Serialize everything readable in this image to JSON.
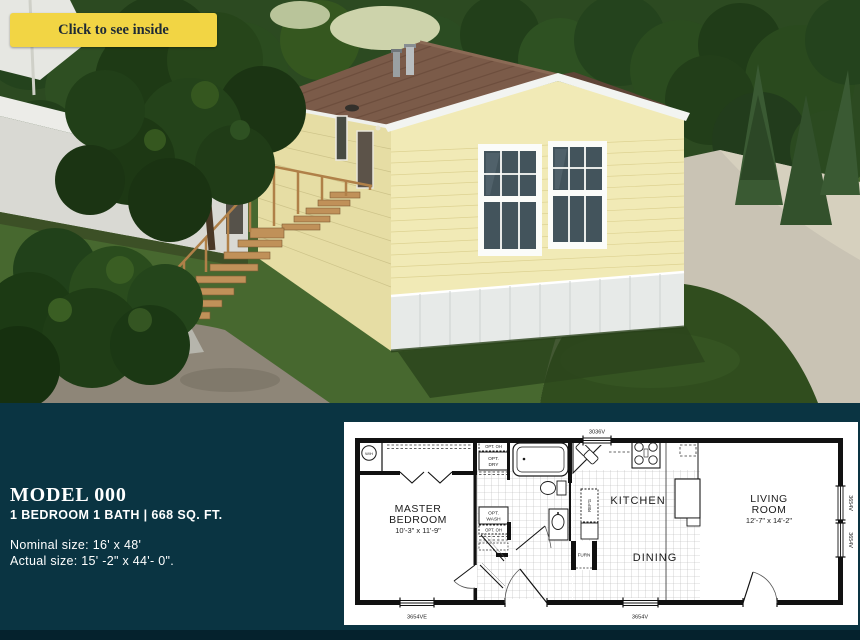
{
  "cta": {
    "label": "Click to see inside"
  },
  "info": {
    "title": "MODEL 000",
    "subtitle": "1 BEDROOM 1 BATH | 668 SQ. FT.",
    "nominal_size": "Nominal size: 16' x 48'",
    "actual_size": "Actual size: 15' -2\" x 44'- 0\"."
  },
  "colors": {
    "panel_bg": "#0a3442",
    "footer_bg": "#05222d",
    "accent_yellow": "#f2d544",
    "button_text": "#1e2a36",
    "text": "#ffffff"
  },
  "floorplan": {
    "master_bedroom": {
      "line1": "MASTER",
      "line2": "BEDROOM",
      "dims": "10'-3\" x 11'-9\""
    },
    "living_room": {
      "line1": "LIVING",
      "line2": "ROOM",
      "dims": "12'-7\" x 14'-2\""
    },
    "kitchen": "KITCHEN",
    "dining": "DINING",
    "labels": {
      "water_heater": "W/H",
      "opt_oh_upper": "OPT. OH",
      "opt_dry_1": "OPT.",
      "opt_dry_2": "DRY",
      "opt_wash_1": "OPT.",
      "opt_wash_2": "WASH",
      "opt_oh_lower": "OPT. OH",
      "fridge": "REF'G",
      "furnace": "FURN"
    },
    "windows": {
      "top": "3036V",
      "bottom_left": "3654VE",
      "bottom_center": "3654V",
      "right_upper": "3654V",
      "right_lower": "3654V"
    }
  }
}
